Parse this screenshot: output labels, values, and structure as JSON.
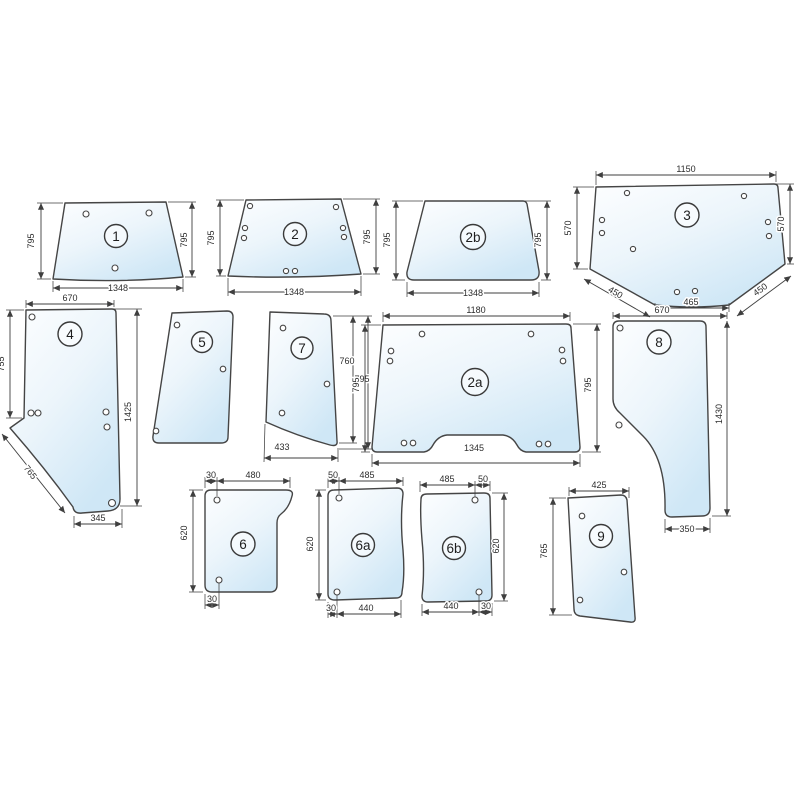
{
  "diagram": {
    "type": "tractor-cab-glass-dimension-diagram",
    "colors": {
      "background": "#ffffff",
      "line": "#3f3f3f",
      "glass_tint_light": "#fdfeff",
      "glass_tint_dark": "#cfe7f6"
    },
    "panels": {
      "p1": {
        "label": "1",
        "dims": {
          "left": "795",
          "right": "795",
          "bottom": "1348"
        }
      },
      "p2": {
        "label": "2",
        "dims": {
          "left": "795",
          "right": "795",
          "bottom": "1348"
        }
      },
      "p2b": {
        "label": "2b",
        "dims": {
          "left": "795",
          "right": "795",
          "bottom": "1348"
        }
      },
      "p3": {
        "label": "3",
        "dims": {
          "top": "1150",
          "left": "570",
          "right": "570",
          "bottom_left": "450",
          "bottom_center": "465",
          "bottom_right": "450"
        }
      },
      "p4": {
        "label": "4",
        "dims": {
          "top": "670",
          "left": "755",
          "right": "1425",
          "diagonal": "765",
          "bottom": "345"
        }
      },
      "p5": {
        "label": "5",
        "dims": {}
      },
      "p7": {
        "label": "7",
        "dims": {
          "inner_height": "760",
          "right": "795",
          "bottom": "433"
        }
      },
      "p2a": {
        "label": "2a",
        "dims": {
          "top": "1180",
          "left": "795",
          "right": "795",
          "bottom": "1345"
        }
      },
      "p8": {
        "label": "8",
        "dims": {
          "top": "670",
          "right": "1430",
          "bottom": "350"
        }
      },
      "p6": {
        "label": "6",
        "dims": {
          "top_offset": "30",
          "top": "480",
          "left": "620",
          "bottom_offset": "30"
        }
      },
      "p6a": {
        "label": "6a",
        "dims": {
          "top_offset": "50",
          "top": "485",
          "left": "620",
          "bottom_offset": "30",
          "bottom": "440"
        }
      },
      "p6b": {
        "label": "6b",
        "dims": {
          "top": "485",
          "top_offset": "50",
          "right": "620",
          "bottom": "440",
          "bottom_offset": "30"
        }
      },
      "p9": {
        "label": "9",
        "dims": {
          "top": "425",
          "left": "765"
        }
      }
    }
  }
}
